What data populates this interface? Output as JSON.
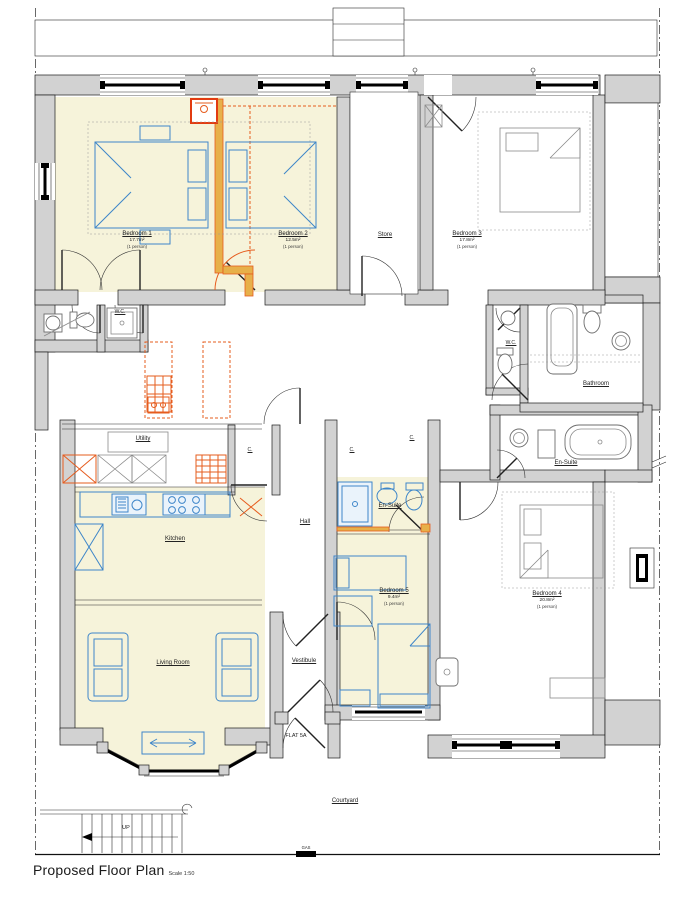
{
  "title": {
    "text": "Proposed Floor Plan",
    "scale": "Scale 1:50"
  },
  "rooms": {
    "bedroom1": {
      "name": "Bedroom 1",
      "area": "17.7m²",
      "occupancy": "(1 person)"
    },
    "bedroom2": {
      "name": "Bedroom 2",
      "area": "12.5m²",
      "occupancy": "(1 person)"
    },
    "store": {
      "name": "Store"
    },
    "bedroom3": {
      "name": "Bedroom 3",
      "area": "17.8m²",
      "occupancy": "(1 person)"
    },
    "wc": {
      "name": "W.C."
    },
    "bathroom": {
      "name": "Bathroom"
    },
    "ensuite": {
      "name": "En-Suite"
    },
    "bedroom4": {
      "name": "Bedroom 4",
      "area": "20.8m²",
      "occupancy": "(1 person)"
    },
    "bedroom5": {
      "name": "Bedroom 5",
      "area": "9.4m²",
      "occupancy": "(1 person)"
    },
    "hall": {
      "name": "Hall"
    },
    "utility": {
      "name": "Utility"
    },
    "kitchen": {
      "name": "Kitchen"
    },
    "living": {
      "name": "Living Room"
    },
    "vestibule": {
      "name": "Vestibule"
    },
    "courtyard": {
      "name": "Courtyard"
    },
    "cupboard": {
      "name": "C."
    }
  },
  "annotations": {
    "flat": "FLAT 5A",
    "up": "UP",
    "gas": "GAS"
  },
  "colors": {
    "wall": "#d2d2d2",
    "cream": "#f6f3da",
    "blue": "#3e86c9",
    "orange": "#e65c1e",
    "tan": "#e7b04a"
  }
}
